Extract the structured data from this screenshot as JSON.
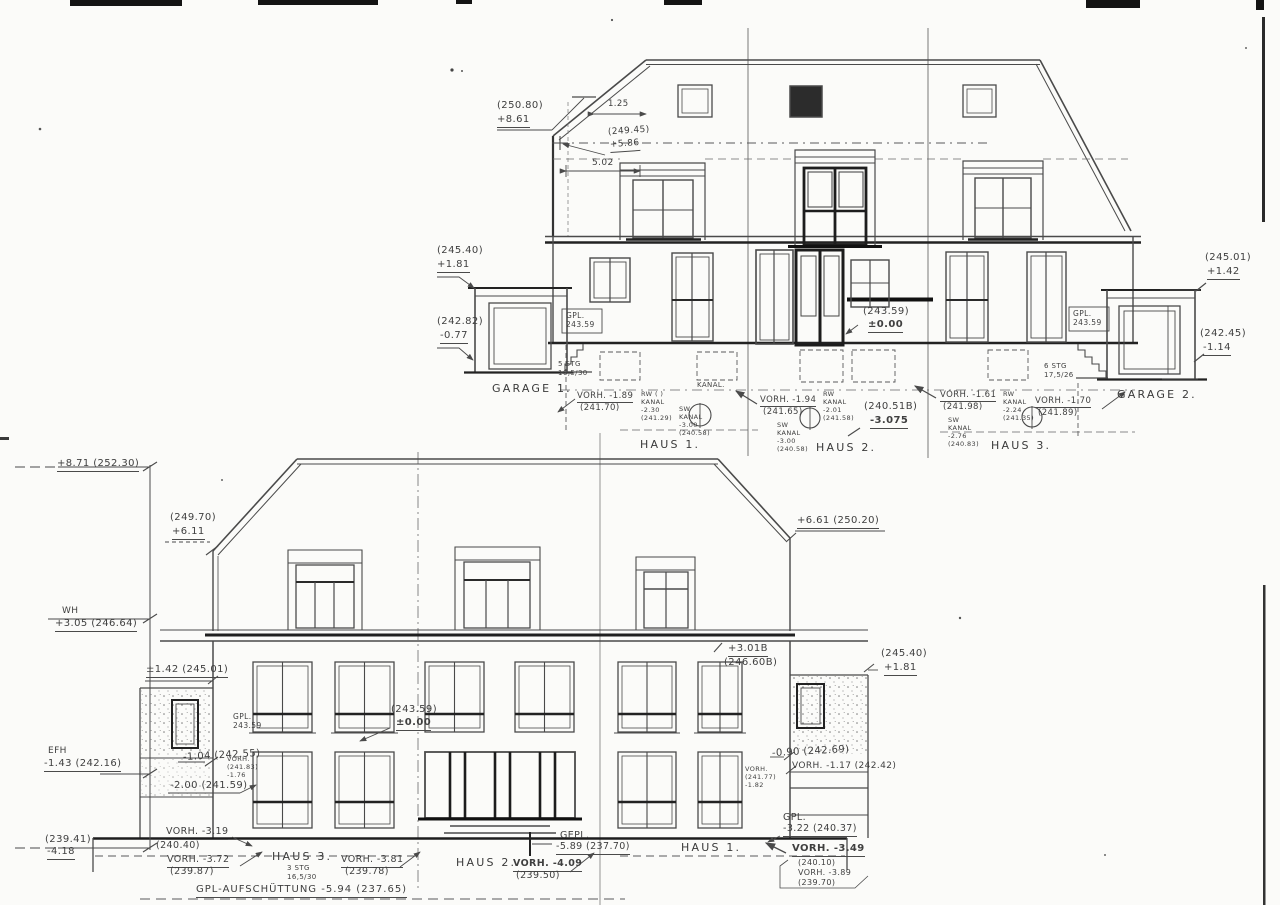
{
  "upper": {
    "ridge_elev": "(250.80)",
    "ridge_rel": "+8.61",
    "dim_overhang": "1.25",
    "attic_elev": "(249.45)",
    "attic_rel": "+5.86",
    "dim_gable": "5.02",
    "g1_top_elev": "(245.40)",
    "g1_top_rel": "+1.81",
    "g1_base_elev": "(242.82)",
    "g1_base_rel": "-0.77",
    "gpl_left": "GPL.\n243.59",
    "zero_elev": "(243.59)",
    "zero_rel": "±0.00",
    "gpl_right": "GPL.\n243.59",
    "g2_top_elev": "(245.01)",
    "g2_top_rel": "+1.42",
    "g2_base_elev": "(242.45)",
    "g2_base_rel": "-1.14",
    "stairs_left": "5 STG\n16,5/30",
    "stairs_right": "6 STG\n17,5/26",
    "garage1": "GARAGE 1.",
    "garage2": "GARAGE 2.",
    "kanal": "KANAL.",
    "h1_vorh": "VORH. -1.89",
    "h1_vorh_elev": "(241.70)",
    "h1_rw": "RW ( )\nKANAL\n-2.30\n(241.29)",
    "h1_sw": "SW\nKANAL\n-3.00\n(240.58)",
    "haus1": "HAUS 1.",
    "h2_vorh": "VORH. -1.94",
    "h2_vorh_elev": "(241.65)",
    "h2_rw": "RW\nKANAL\n-2.01\n(241.58)",
    "h2_level_elev": "(240.51B)",
    "h2_level_rel": "-3.075",
    "h2_sw": "SW\nKANAL\n-3.00\n(240.58)",
    "haus2": "HAUS 2.",
    "h3_vorh": "VORH. -1.61",
    "h3_vorh_elev": "(241.98)",
    "h3_rw": "RW\nKANAL\n-2.24\n(241.35)",
    "h3_sw": "SW\nKANAL\n-2.76\n(240.83)",
    "haus3": "HAUS 3.",
    "h3_vorh2": "VORH. -1.70",
    "h3_vorh2_elev": "(241.89)"
  },
  "lower": {
    "datum_ridge": "+8.71 (252.30)",
    "roof_left_elev": "(249.70)",
    "roof_left_rel": "+6.11",
    "roof_right": "+6.61 (250.20)",
    "datum_wh_label": "WH",
    "datum_wh": "+3.05 (246.64)",
    "wall_left_top": "±1.42 (245.01)",
    "gpl_left": "GPL.\n243.59",
    "zero_elev": "(243.59)",
    "zero_rel": "±0.00",
    "attic_rel": "+3.01B",
    "attic_elev": "(246.60B)",
    "wall_right_top_elev": "(245.40)",
    "wall_right_top_rel": "+1.81",
    "datum_efh_label": "EFH",
    "datum_efh": "-1.43 (242.16)",
    "m104": "-1.04 (242.55)",
    "vorh_small_left": "VORH.\n(241.83)\n-1.76",
    "m200": "-2.00 (241.59)",
    "m090": "-0.90 (242.69)",
    "vorh117": "VORH. -1.17 (242.42)",
    "vorh_small_right": "VORH.\n(241.77)\n-1.82",
    "gpl322_label": "GPL.",
    "gpl322": "-3.22 (240.37)",
    "datum_base_elev": "(239.41)",
    "datum_base_rel": "-4.18",
    "vorh319": "VORH. -3.19",
    "l24040": "(240.40)",
    "vorh372": "VORH. -3.72",
    "vorh372_elev": "(239.87)",
    "haus3": "HAUS 3.",
    "stairs3": "3 STG\n16,5/30",
    "vorh381": "VORH. -3.81",
    "vorh381_elev": "(239.78)",
    "haus2": "HAUS 2.",
    "vorh409": "VORH. -4.09",
    "vorh409_elev": "(239.50)",
    "gepl_label": "GEPL.",
    "gepl": "-5.89 (237.70)",
    "haus1": "HAUS 1.",
    "vorh349": "VORH. -3.49",
    "block349": "(240.10)\nVORH. -3.89\n(239.70)",
    "fill_note": "GPL-AUFSCHÜTTUNG -5.94 (237.65)"
  }
}
